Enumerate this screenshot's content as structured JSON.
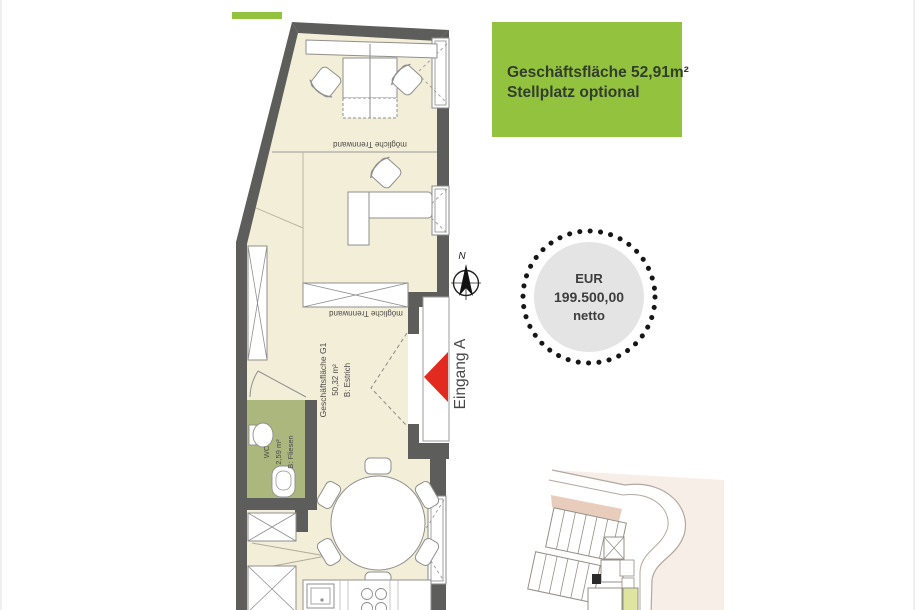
{
  "info_box": {
    "line1": "Geschäftsfläche 52,91m²",
    "line2": "Stellplatz optional",
    "background": "#92c23e"
  },
  "price_badge": {
    "currency": "EUR",
    "amount": "199.500,00",
    "suffix": "netto",
    "circle_color": "#e4e4e4",
    "dot_color": "#161616"
  },
  "compass": {
    "north_label": "N"
  },
  "entrance": {
    "label": "Eingang A",
    "arrow_color": "#e22a20"
  },
  "floor_plan": {
    "partition_label": "mögliche Trennwand",
    "main_room": {
      "name": "Geschäftsfläche G1",
      "area": "50,32 m²",
      "floor": "B: Estrich"
    },
    "wc": {
      "name": "WC",
      "area": "2,59 m²",
      "floor": "B: Fliesen"
    },
    "wall_color": "#5d5d5b",
    "floor_color": "#f3eed8",
    "wc_floor_color": "#abb77c"
  },
  "accent_bar_color": "#92c23e"
}
